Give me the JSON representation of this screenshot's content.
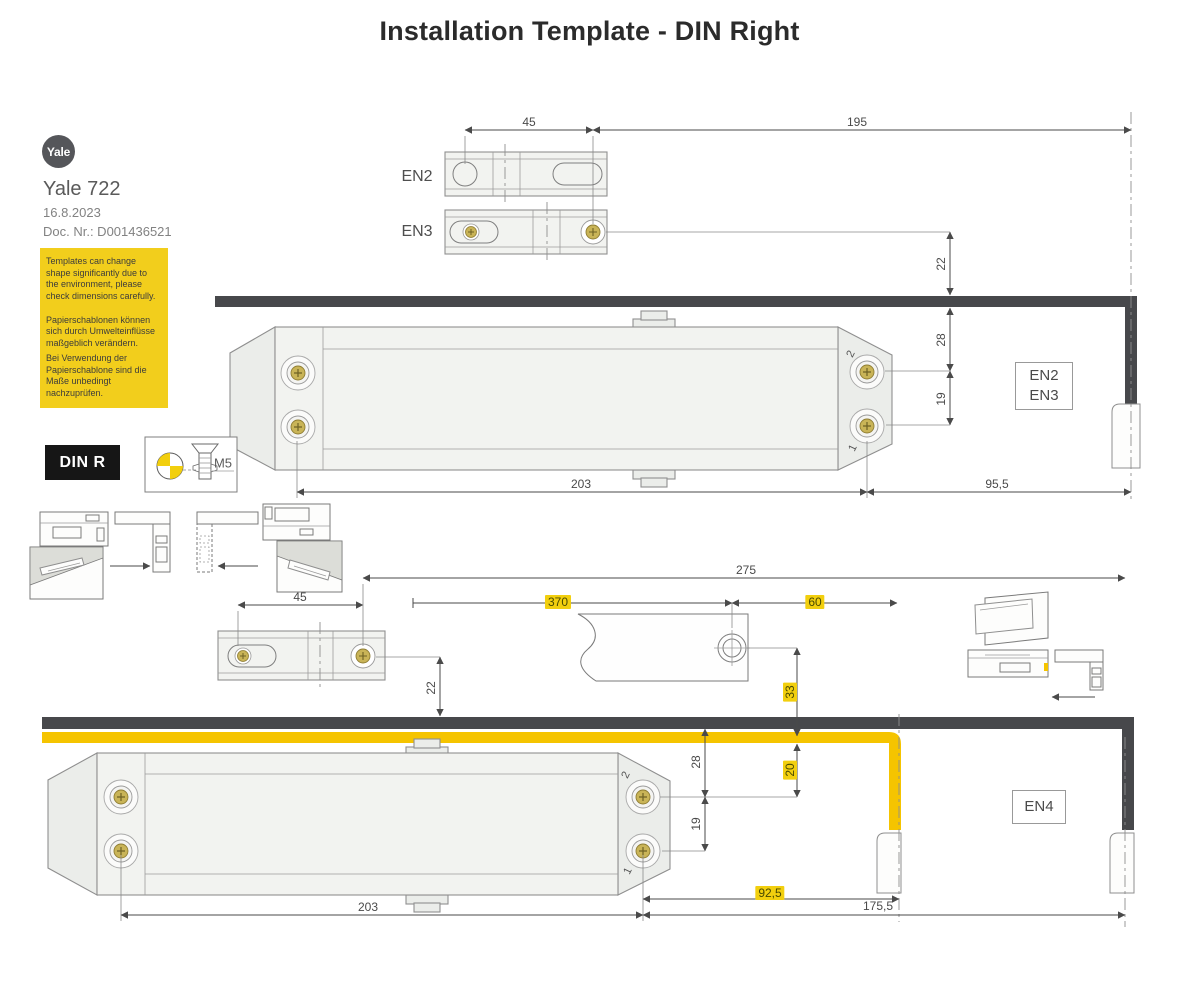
{
  "title": "Installation Template - DIN Right",
  "brand": {
    "logo_text": "Yale",
    "product": "Yale 722",
    "date": "16.8.2023",
    "doc_nr": "Doc. Nr.: D001436521"
  },
  "warning_box": {
    "bg_color": "#f2ce1c",
    "text_en": "Templates can change shape significantly due to the environment, please check dimensions carefully.",
    "text_de_1": "Papierschablonen können sich durch Umwelteinflüsse maßgeblich verändern.",
    "text_de_2": "Bei Verwendung der Papierschablone sind die Maße unbedingt nachzuprüfen."
  },
  "din_badge": "DIN R",
  "screw_spec_label": "M5",
  "colors": {
    "highlight_yellow": "#f2cf0e",
    "frame_dark": "#47484b",
    "slide_channel_yellow": "#f5c400"
  },
  "top_diagram": {
    "bracket_en2_label": "EN2",
    "bracket_en3_label": "EN3",
    "dim_hole_spacing": "45",
    "dim_bracket_to_hinge": "195",
    "dim_frame_to_holes": "22",
    "dim_frame_to_screw2": "28",
    "dim_screw2_to_screw1": "19",
    "dim_body_screws": "203",
    "dim_body_to_hinge": "95,5",
    "rating_line1": "EN2",
    "rating_line2": "EN3",
    "screw2_label": "2",
    "screw1_label": "1"
  },
  "bottom_diagram": {
    "dim_hole_spacing": "45",
    "dim_bracket_to_hinge": "275",
    "dim_arm_length": "370",
    "dim_arm_to_channel_end": "60",
    "dim_frame_to_holes": "22",
    "dim_hole_to_channel": "33",
    "dim_frame_to_screw2": "28",
    "dim_screw2_to_screw1": "19",
    "dim_channel_to_screw2": "20",
    "dim_body_screws": "203",
    "dim_screw_to_channel_end": "92,5",
    "dim_screw_to_hinge": "175,5",
    "rating_line1": "EN4",
    "screw2_label": "2",
    "screw1_label": "1"
  }
}
